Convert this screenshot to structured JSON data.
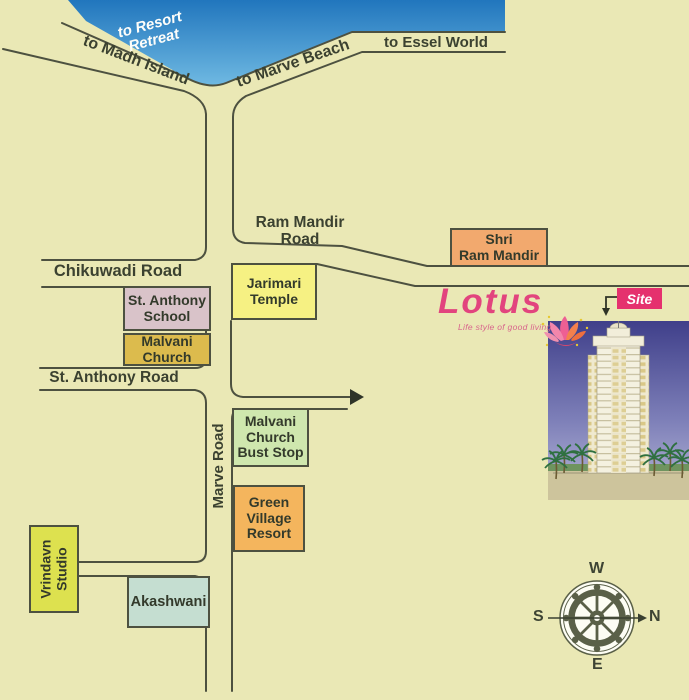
{
  "water": {
    "label": "to Resort\nRetreat"
  },
  "roads": {
    "to_madh_island": "to Madh Island",
    "to_marve_beach": "to Marve Beach",
    "to_essel_world": "to Essel World",
    "ram_mandir_road": "Ram Mandir Road",
    "chikuwadi_road": "Chikuwadi Road",
    "st_anthony_road": "St. Anthony Road",
    "marve_road": "Marve Road"
  },
  "landmarks": {
    "shri_ram_mandir": "Shri\nRam Mandir",
    "jarimari_temple": "Jarimari\nTemple",
    "st_anthony_school": "St. Anthony\nSchool",
    "malvani_church": "Malvani\nChurch",
    "malvani_church_bust_stop": "Malvani\nChurch\nBust Stop",
    "green_village_resort": "Green\nVillage\nResort",
    "vrindavn_studio": "Vrindavn\nStudio",
    "akashwani": "Akashwani"
  },
  "brand": {
    "name": "Lotus",
    "tagline": "Life style of good living",
    "site_label": "Site"
  },
  "compass": {
    "top": "W",
    "left": "S",
    "right": "N",
    "bottom": "E"
  },
  "colors": {
    "background": "#eae8b5",
    "water_top": "#2176bd",
    "water_shore": "#6fb9e2",
    "road_line": "#4d5140",
    "brand_pink": "#e2447e",
    "site_pink": "#e5316e",
    "shri_ram_mandir": "#f2a96e",
    "jarimari_temple": "#f6f183",
    "st_anthony_school": "#d9c3c9",
    "malvani_church": "#dcbb4d",
    "malvani_church_bust_stop": "#cfe7ae",
    "green_village_resort": "#f4b55d",
    "vrindavn_studio": "#dde14f",
    "akashwani": "#c5ded1",
    "compass": "#5a6048"
  }
}
